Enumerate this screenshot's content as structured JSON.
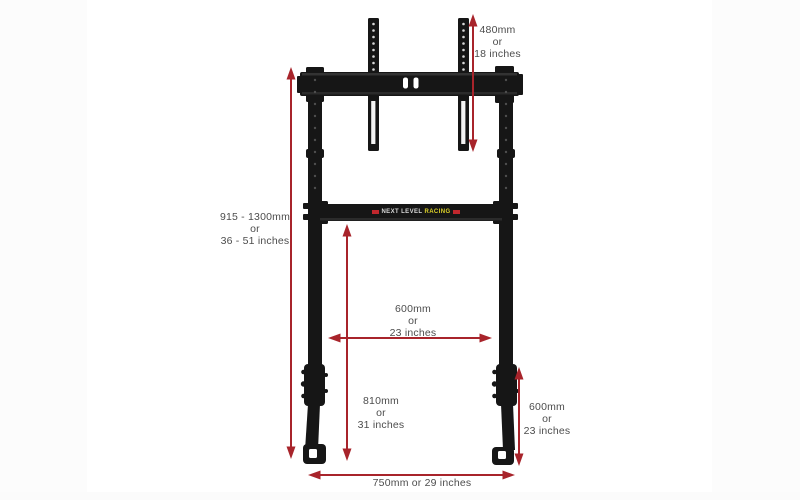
{
  "diagram": {
    "logo": {
      "part1": "NEXT LEVEL",
      "part2": "RACING"
    },
    "labels": {
      "vesa_height": {
        "mm": "480mm",
        "conj": "or",
        "inches": "18 inches"
      },
      "overall_height": {
        "mm": "915 - 1300mm",
        "conj": "or",
        "inches": "36 - 51 inches"
      },
      "inner_width": {
        "mm": "600mm",
        "conj": "or",
        "inches": "23 inches"
      },
      "crossbar_height": {
        "mm": "810mm",
        "conj": "or",
        "inches": "31 inches"
      },
      "leg_section_height": {
        "mm": "600mm",
        "conj": "or",
        "inches": "23 inches"
      },
      "base_width": {
        "text": "750mm or 29 inches"
      }
    },
    "colors": {
      "arrow_red": "#a8242b",
      "label_gray": "#4d4d4d",
      "frame_black": "#161616",
      "logo_red": "#c1272d",
      "logo_yellow": "#ddd229",
      "logo_text_gray": "#d9d9d9",
      "background": "#ffffff"
    }
  }
}
